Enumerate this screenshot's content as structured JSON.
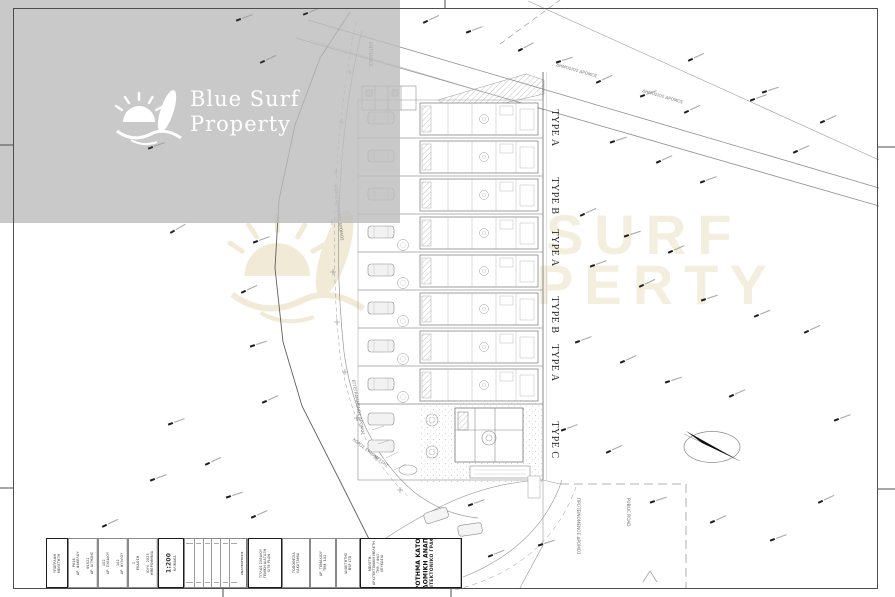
{
  "branding": {
    "logo_line1": "Blue Surf",
    "logo_line2": "Property",
    "logo_color": "#ffffff",
    "overlay_color": "#bdbdbd",
    "watermark_color": "#f3eedd",
    "watermark_line1": "SURF",
    "watermark_line2": "PERTY"
  },
  "plan": {
    "entrance_label": "ENTRANCE",
    "type_labels": [
      "TYPE A",
      "TYPE B",
      "TYPE A",
      "TYPE B",
      "TYPE A",
      "TYPE C"
    ],
    "small_labels": [
      "ΕΓΓΕΓΡΑΜΜΕΝΟΣ ΔΡΟΜΟΣ",
      "ΕΓΓΕΓΡΑΜΜΕΝΟΣ ΔΡΟΜΟΣ",
      "ΔΗΜΟΣΙΟΣ ΔΡΟΜΟΣ",
      "ΔΗΜΟΣΙΟΣ ΔΡΟΜΟΣ",
      "ΠΡΟΤΕΙΝΟΜΕΝΟΣ ΔΡΟΜΟΣ",
      "PUBLIC ROAD",
      "ΧΩΡΟΣ ΣΤΑΘΜΕΥΣΗΣ"
    ],
    "north_arrow": "north-arrow",
    "scale": "1:200"
  },
  "title_block": {
    "cells": [
      {
        "w": 22,
        "bold": true,
        "cols": [
          [
            "ΥΠΟΓΡΑΦΗ",
            "ΜΕΛΕΤΗΤΗ"
          ]
        ]
      },
      {
        "w": 30,
        "bold": false,
        "cols": [
          [
            "Ρ616",
            "ΑΡ. ΦΑΚΕΛΟΥ"
          ],
          [
            "Φ1822",
            "ΑΡ. ΑΙΤΗΣΗΣ"
          ]
        ]
      },
      {
        "w": 30,
        "bold": false,
        "cols": [
          [
            "102",
            "ΑΡ. ΣΧΕΔΙΟΥ"
          ],
          [
            "102",
            "ΑΡ. ΦΥΛΛΟΥ"
          ]
        ]
      },
      {
        "w": 30,
        "bold": false,
        "cols": [
          [
            "1",
            "ΕΚΔΟΣΗ"
          ],
          [
            "ΙΟΥΛ. 2023",
            "ΗΜΕΡΟΜΗΝΙΑ"
          ]
        ]
      },
      {
        "w": 26,
        "bold": true,
        "cols": [
          [
            "1:200",
            "ΚΛΙΜΑΚΑ"
          ]
        ],
        "scale": true
      },
      {
        "w": 64,
        "grid": 6,
        "label": "ΑΝΑΘΕΩΡΗΣΕΙΣ"
      },
      {
        "w": 34,
        "bold": true,
        "cols": [
          [
            "ΤΙΤΛΟΣ ΣΧΕΔΙΟΥ",
            "ΓΕΝΙΚΗ ΔΙΑΤΑΞΗ",
            "SITE PLAN"
          ]
        ]
      },
      {
        "w": 28,
        "bold": false,
        "cols": [
          [
            "ΤΟΠΟΘΕΣΙΑ",
            "ΛΑΚΑΤΑΜΙΑ"
          ]
        ]
      },
      {
        "w": 26,
        "bold": false,
        "cols": [
          [
            "ΑΡ. ΤΕΜΑΧΙΟΥ",
            "ΤΕΜ. 102"
          ]
        ]
      },
      {
        "w": 24,
        "bold": false,
        "cols": [
          [
            "ΙΔΙΟΚΤΗΤΗΣ",
            "BSP LTD"
          ]
        ]
      },
      {
        "w": 102,
        "bold": true,
        "big": true,
        "small_lines": [
          "ΜΕΛΕΤΗ:",
          "ΑΡΧΙΤΕΚΤΟΝΙΚΗ ΜΕΛΕΤΗ",
          "ΤΗΛ. / ΦΑΞ",
          "ΛΕΥΚΩΣΙΑ"
        ],
        "big_lines": [
          "ΣΥΓΚΡΟΤΗΜΑ ΚΑΤΟΙΚΙΩΝ",
          "ΟΙΚΟΔΟΜΙΚΗ ΑΝΑΠΤΥΞΗ",
          "ΑΡΧΙΤΕΚΤΟΝΙΚΟ ΓΡΑΦΕΙΟ"
        ]
      }
    ]
  }
}
